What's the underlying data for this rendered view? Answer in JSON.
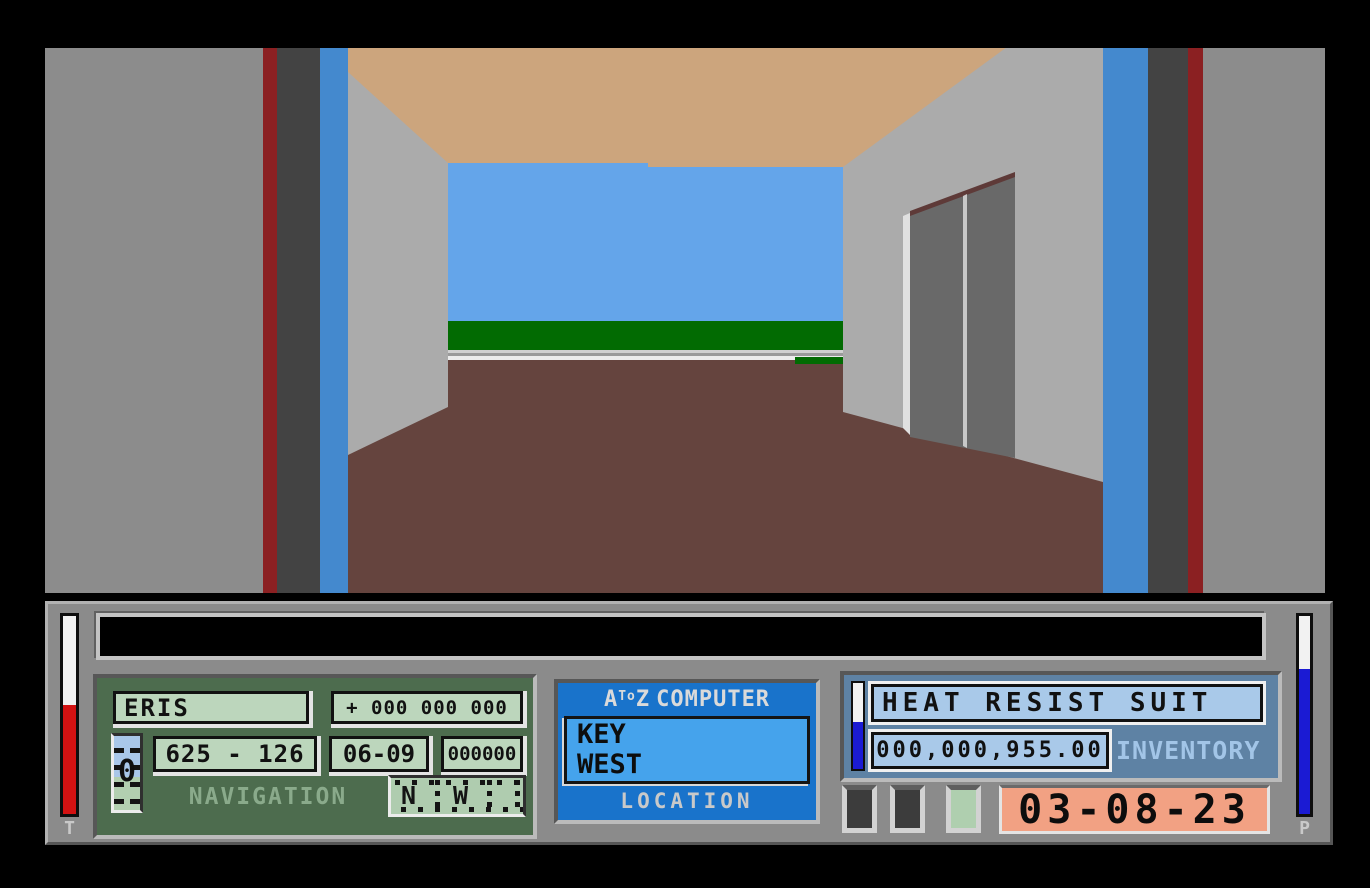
{
  "scene": {
    "colors": {
      "near_wall": "#8C8C8C",
      "stripe_red": "#8B2022",
      "stripe_dark": "#434343",
      "stripe_blue": "#4489CE",
      "interior_wall": "#ABABAB",
      "ceiling": "#CCA57D",
      "sky": "#64A5EA",
      "grass": "#026B02",
      "road_light": "#D0D0D0",
      "road_mid": "#9A9A9A",
      "road_white": "#ECECEC",
      "floor": "#65443E",
      "door": "#696969",
      "door_frame": "#E0E0E0",
      "door_divider": "#C8C8C8",
      "door_lintel": "#5E3A38",
      "frame_line": "#000000"
    }
  },
  "hud": {
    "message_bar": {
      "text": ""
    },
    "gauges": {
      "temperature_label": "T",
      "power_label": "P"
    },
    "navigation": {
      "planet": "ERIS",
      "offset": "+ 000 000 000",
      "coordinates": "625 - 126",
      "sector": "06-09",
      "counter": "000000",
      "label": "NAVIGATION",
      "altitude": "0",
      "compass_n": "N",
      "compass_w": "W"
    },
    "computer": {
      "brand_a": "A",
      "brand_small": "To",
      "brand_z": "Z",
      "title": "COMPUTER",
      "location_line1": "KEY",
      "location_line2": "WEST",
      "footer": "LOCATION"
    },
    "inventory": {
      "item": "HEAT RESIST SUIT",
      "cash": "000,000,955.00",
      "label": "INVENTORY",
      "date": "03-08-23"
    }
  }
}
